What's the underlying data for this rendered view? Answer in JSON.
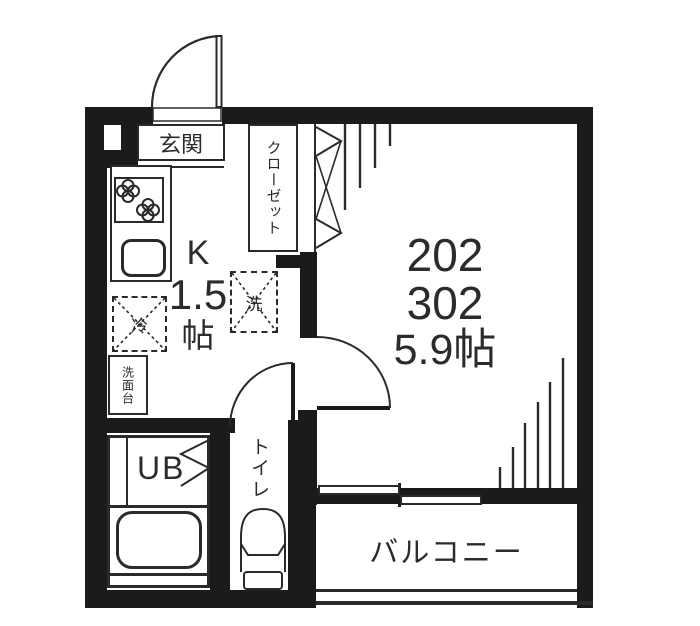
{
  "plan_type": "apartment-floor-plan",
  "labels": {
    "entrance": "玄関",
    "closet": "クローゼット",
    "kitchen_type": "K",
    "kitchen_size": "1.5",
    "kitchen_unit": "帖",
    "refrigerator": "冷",
    "washer": "洗",
    "washbasin": "洗面台",
    "unit_bath": "UB",
    "toilet": "トイレ",
    "balcony": "バルコニー"
  },
  "main_room": {
    "unit_numbers": [
      "202",
      "302"
    ],
    "size": "5.9帖"
  },
  "colors": {
    "wall": "#1b1b1b",
    "line": "#2a2a2a",
    "floor": "#ffffff"
  },
  "icons": {
    "entrance_door": "quarter-arc-swing",
    "room_door": "quarter-arc-swing",
    "toilet_door": "quarter-arc-swing",
    "closet_door": "bifold-zigzag",
    "balcony_door": "sliding-panels",
    "stove": "two-burner-clover-circles",
    "sink": "rounded-rect",
    "bathtub": "rounded-rect",
    "toilet_fixture": "bowl-and-tank",
    "window_hatch": "line-fan"
  }
}
